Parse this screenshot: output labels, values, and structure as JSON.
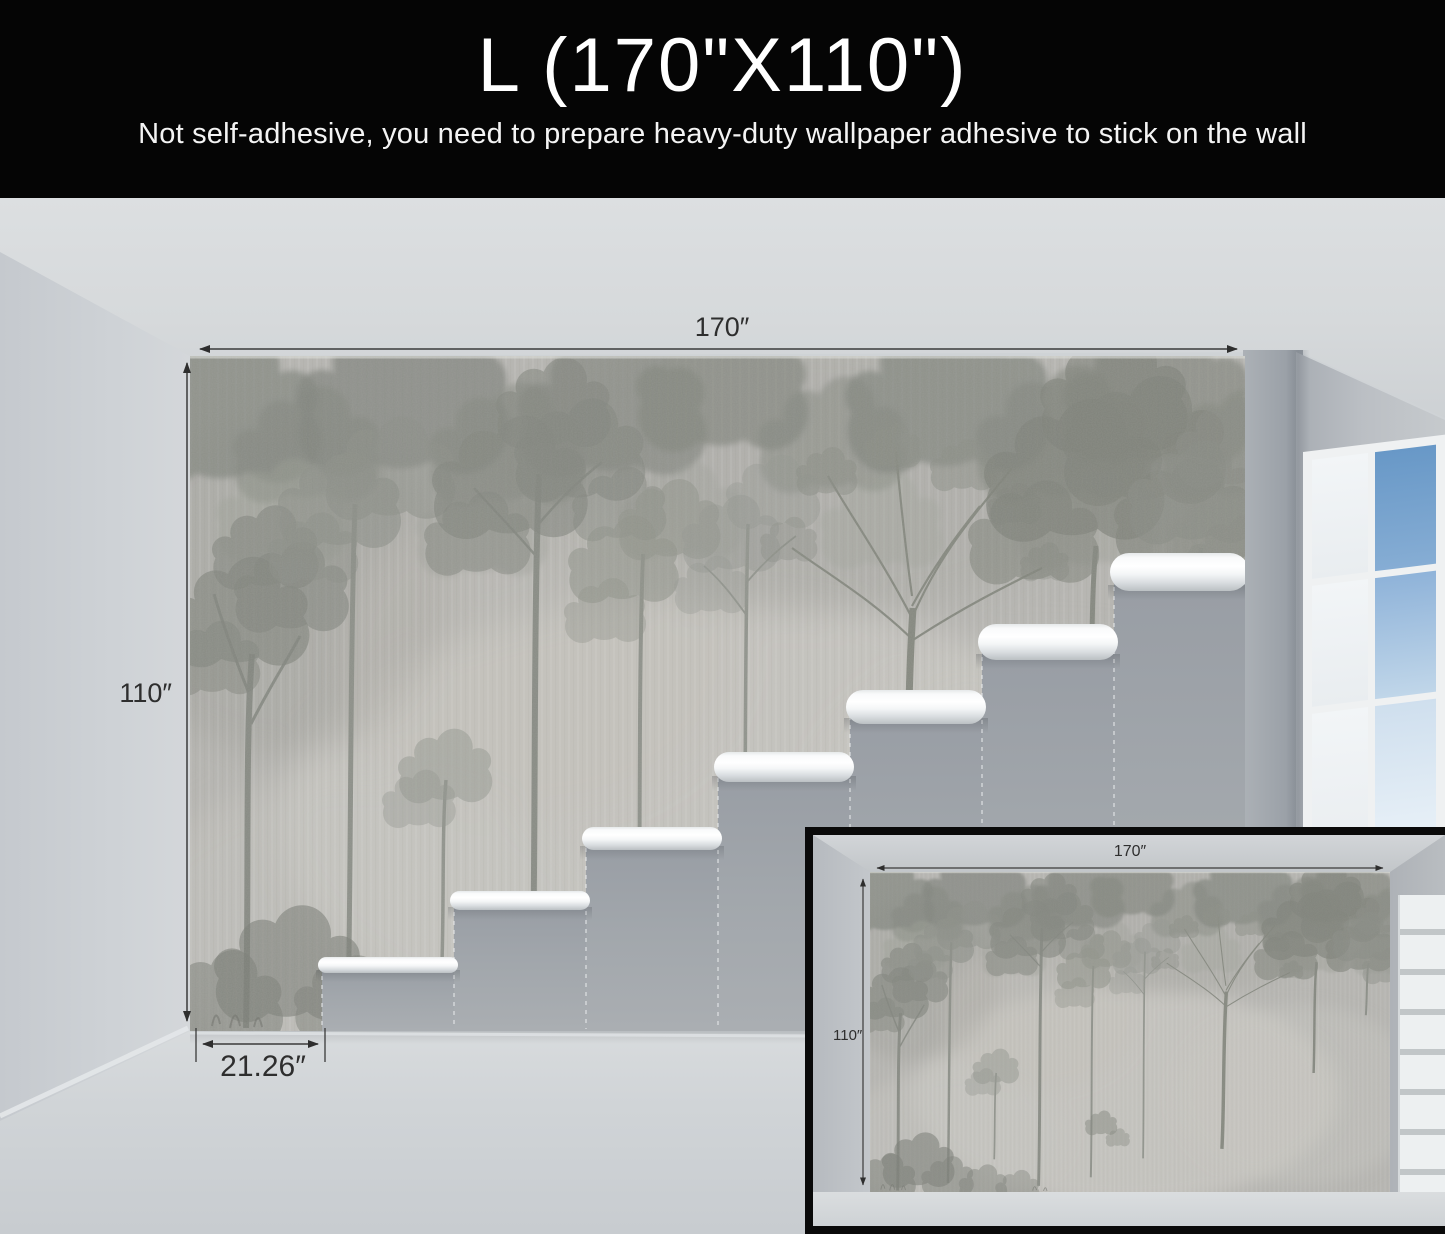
{
  "banner": {
    "size_label": "L (170\"X110\")",
    "note": "Not self-adhesive, you need to prepare heavy-duty wallpaper adhesive to stick on the wall"
  },
  "dimension_labels": {
    "main_width": "170″",
    "main_height": "110″",
    "main_panel_width": "21.26″",
    "inset_width": "170″",
    "inset_height": "110″"
  },
  "colors": {
    "banner_bg": "#050505",
    "banner_text": "#ffffff",
    "annotation": "#2e2e2e",
    "ceiling": "#d6d9db",
    "left_wall": "#cbcfd3",
    "right_wall": "#b7bbc0",
    "floor": "#d0d4d7",
    "unpapered_wall": "#a1a6ab",
    "mural_base": "#b7b6b2",
    "roll_highlight": "#ffffff",
    "sky": "#7aa6d1",
    "window_frame": "#eff1f2",
    "inset_border": "#0a0a0a"
  }
}
